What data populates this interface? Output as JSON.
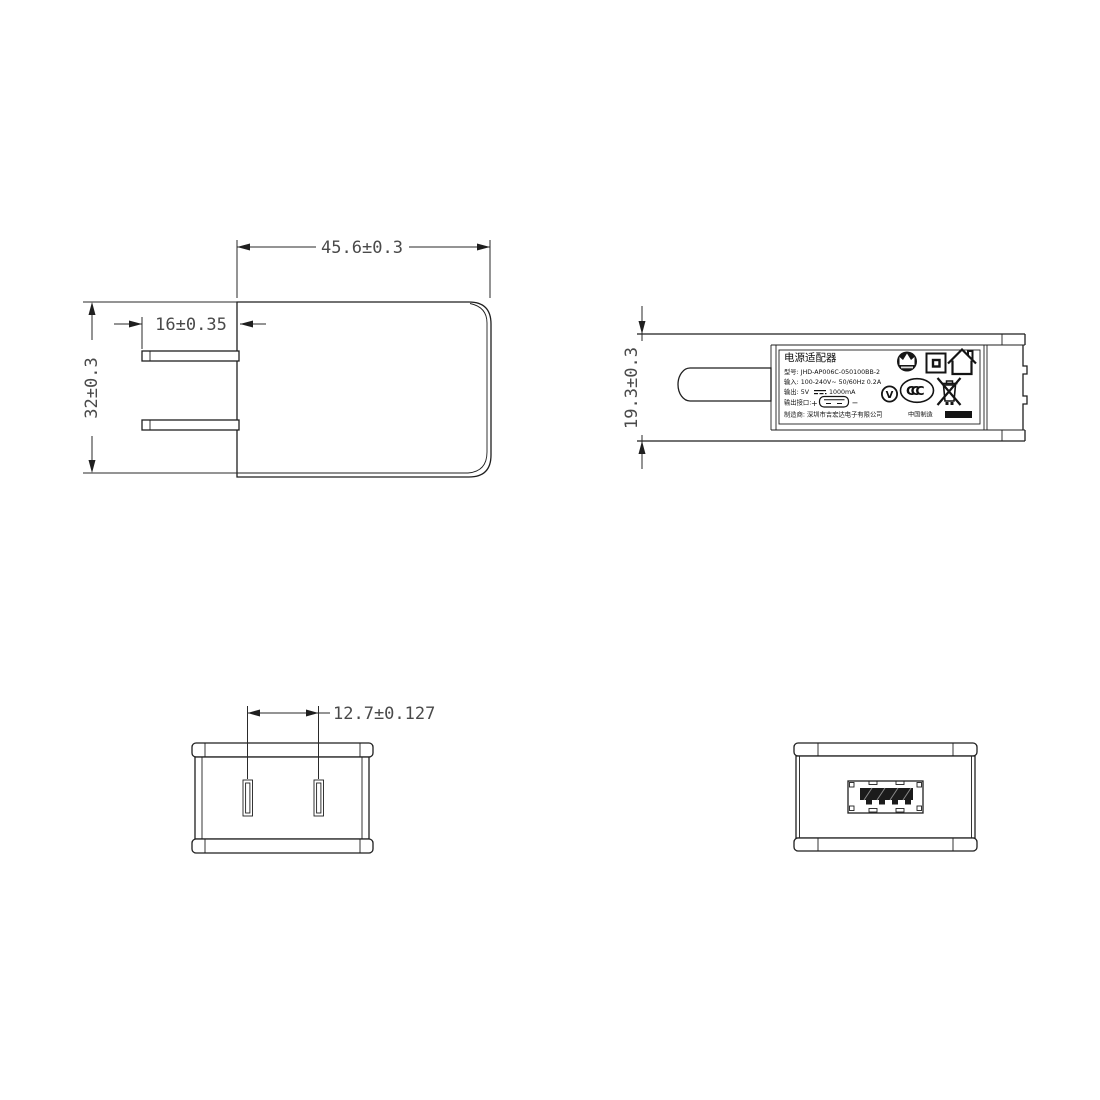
{
  "colors": {
    "line": "#1f1f1f",
    "dim_text": "#4a4a4a",
    "label_text": "#101010"
  },
  "dimensions": {
    "front_width": "45.6±0.3",
    "front_height": "32±0.3",
    "prong_length": "16±0.35",
    "side_thickness": "19.3±0.3",
    "prong_pitch": "12.7±0.127"
  },
  "label": {
    "title": "电源适配器",
    "model_line": "型号: JHD-AP006C-050100BB-2",
    "input_line": "输入: 100-240V~  50/60Hz  0.2A",
    "output_prefix": "输出: 5V",
    "output_suffix": "1000mA",
    "port_label": "输出接口:",
    "port_plus": "+",
    "port_minus": "−",
    "manufacturer_line": "制造商: 深圳市吉宏达电子有限公司",
    "made_in": "中国制造",
    "ccc_text": "CCC",
    "efficiency_text": "V"
  },
  "icons": [
    "brand-logo-icon",
    "class-ii-double-insulation-icon",
    "indoor-use-only-icon",
    "efficiency-level-v-icon",
    "ccc-mark-icon",
    "weee-crossed-bin-icon",
    "usb-connector-icon",
    "dc-symbol-icon"
  ]
}
